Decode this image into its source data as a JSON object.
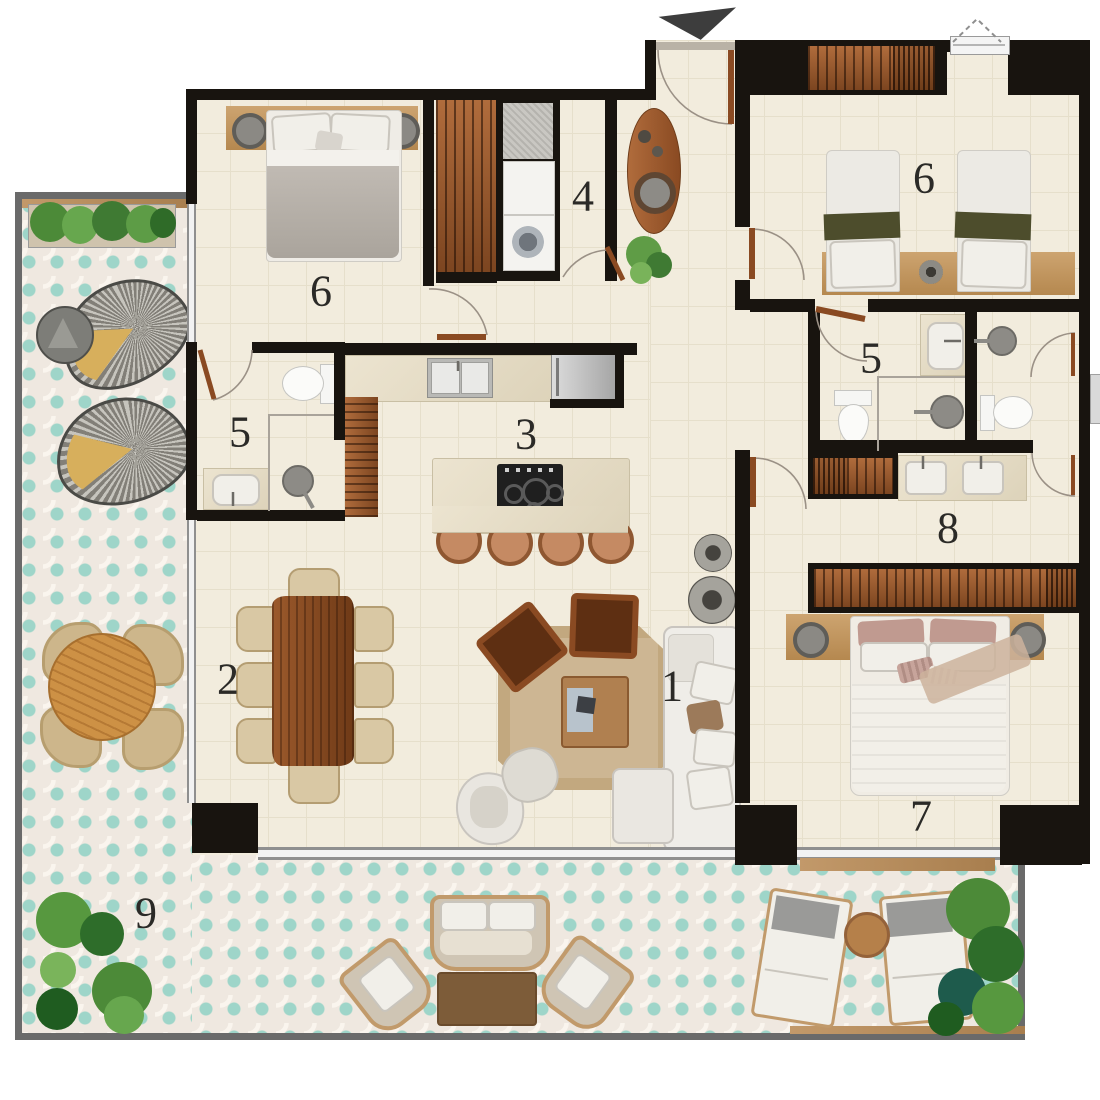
{
  "floor_plan": {
    "room_labels": [
      {
        "id": "living-room",
        "label": "1"
      },
      {
        "id": "dining-room",
        "label": "2"
      },
      {
        "id": "kitchen",
        "label": "3"
      },
      {
        "id": "laundry",
        "label": "4"
      },
      {
        "id": "bathroom-ensuite",
        "label": "5"
      },
      {
        "id": "bathroom-shared",
        "label": "5"
      },
      {
        "id": "bedroom-top-left",
        "label": "6"
      },
      {
        "id": "bedroom-top-right",
        "label": "6"
      },
      {
        "id": "master-bedroom",
        "label": "7"
      },
      {
        "id": "dressing-area",
        "label": "8"
      },
      {
        "id": "terrace",
        "label": "9"
      }
    ],
    "icons": {
      "entrance": "down-arrow"
    },
    "colors": {
      "wall": "#18140f",
      "floor": "#f2ecdd",
      "terrace_teal": "#9ed5c9",
      "terrace_base": "#efe8e0",
      "wood_dark": "#8a4a22",
      "wood_light": "#c2996a",
      "marble": "#e7dfc9",
      "upholstery_white": "#f1efe9",
      "accent_olive": "#4d4d2c",
      "label_text": "#2b2a27"
    }
  }
}
